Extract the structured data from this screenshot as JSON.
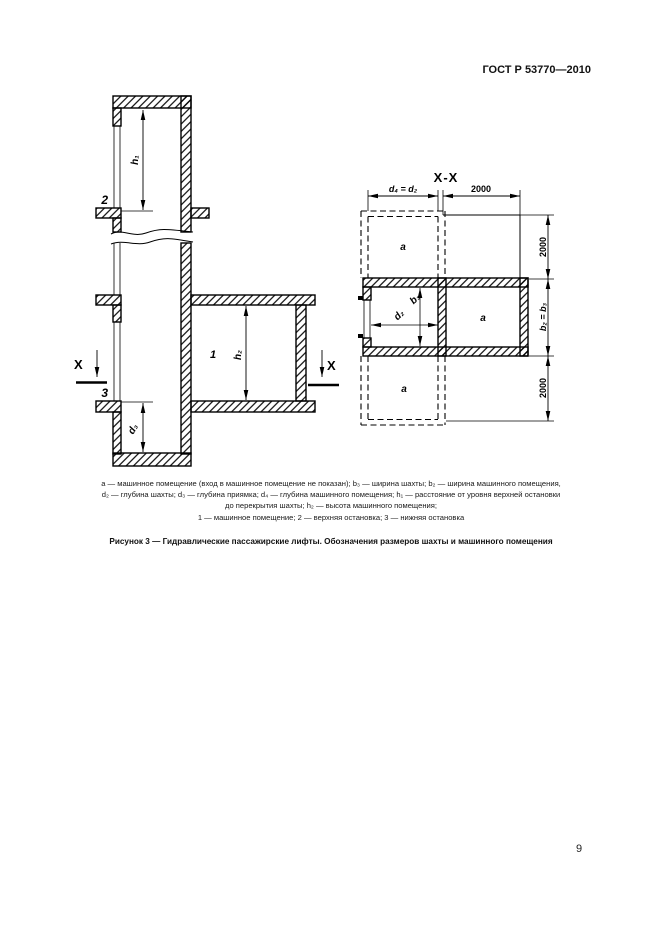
{
  "page": {
    "header_title": "ГОСТ Р 53770—2010",
    "page_number": "9"
  },
  "figure": {
    "caption_lines": [
      "а — машинное помещение (вход в машинное помещение не показан); b₃ — ширина шахты; b₂ — ширина машинного помещения,",
      "d₂ — глубина шахты; d₃ — глубина приямка; d₄ — глубина машинного помещения; h₁ — расстояние от уровня верхней остановки",
      "до перекрытия шахты; h₂ — высота машинного помещения;",
      "1 — машинное помещение; 2 — верхняя остановка; 3 — нижняя остановка"
    ],
    "title": "Рисунок 3 — Гидравлические пассажирские лифты. Обозначения размеров шахты и машинного помещения",
    "section_view": {
      "label_1": "1",
      "label_2": "2",
      "label_3": "3",
      "dim_h1": "h₁",
      "dim_h2": "h₂",
      "dim_d3": "d₃",
      "section_mark_left": "X",
      "section_mark_right": "X"
    },
    "plan_view": {
      "title": "X-X",
      "dim_top_left": "d₄ = d₂",
      "dim_top_right": "2000",
      "dim_right_top": "2000",
      "dim_right_middle": "b₂ = b₃",
      "dim_right_bottom": "2000",
      "dim_shaft_depth": "d₂",
      "dim_shaft_width": "b₃",
      "room_top": "а",
      "room_middle": "а",
      "room_bottom": "а"
    }
  }
}
